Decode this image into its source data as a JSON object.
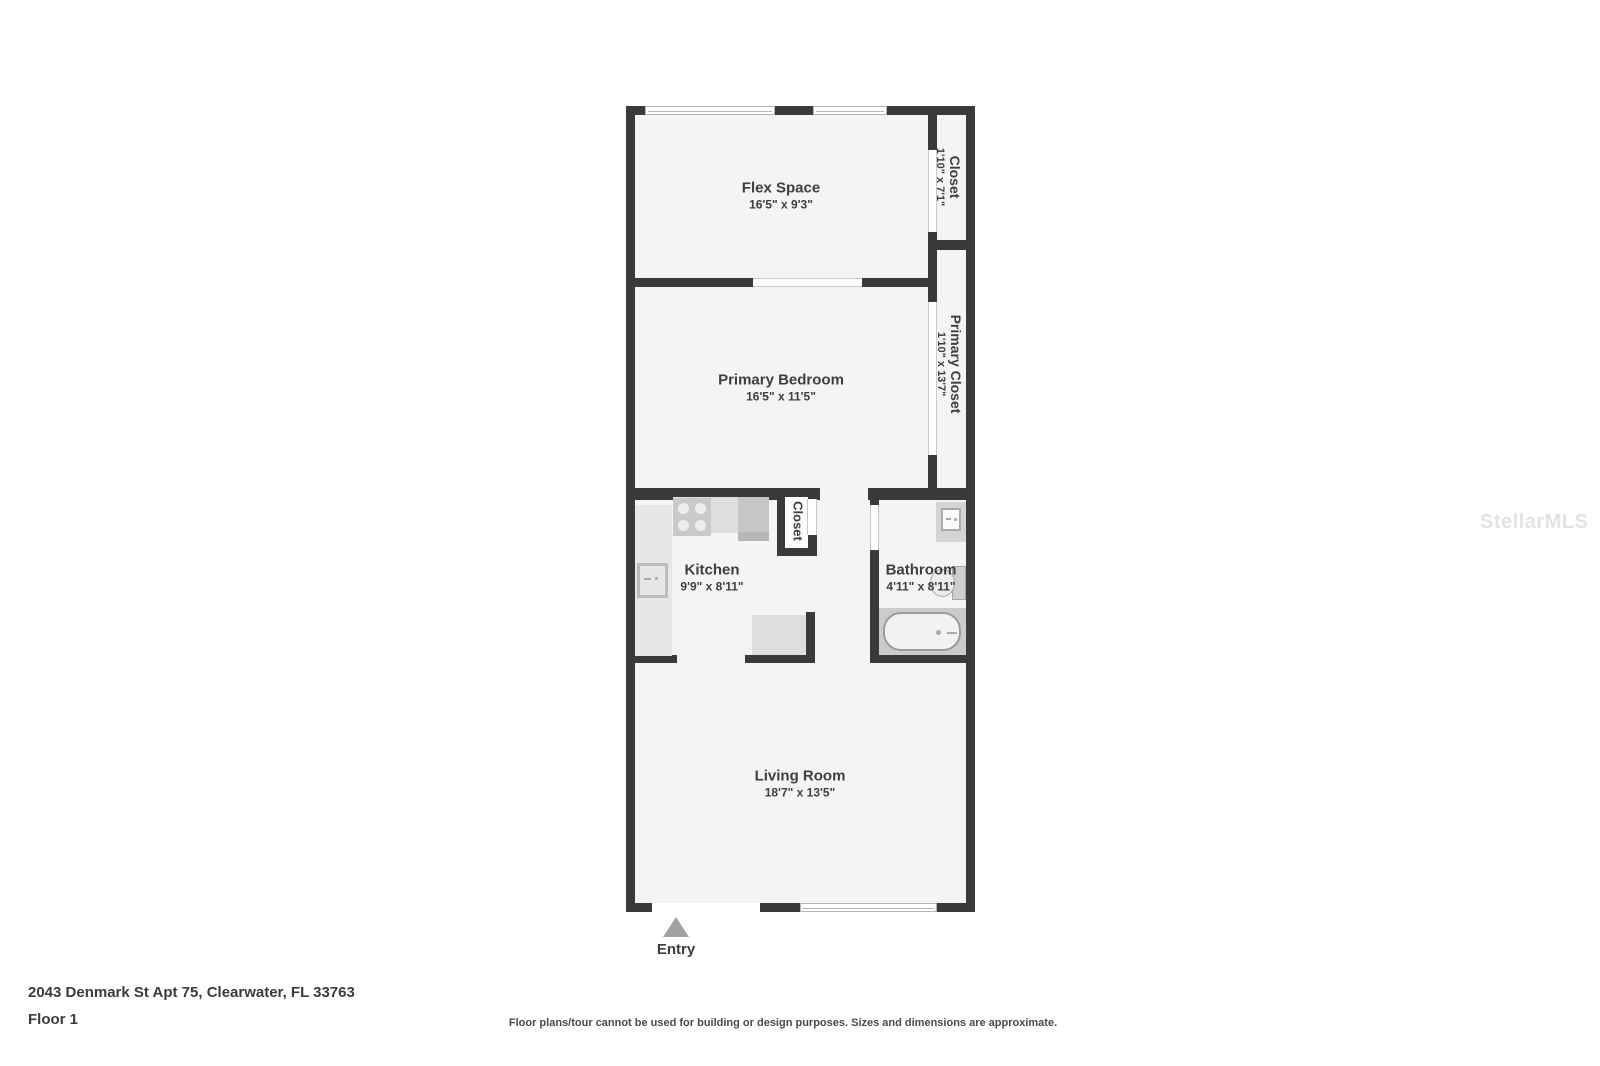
{
  "rooms": {
    "flex_space": {
      "name": "Flex Space",
      "dims": "16'5\" x 9'3\""
    },
    "primary_bedroom": {
      "name": "Primary Bedroom",
      "dims": "16'5\" x 11'5\""
    },
    "kitchen": {
      "name": "Kitchen",
      "dims": "9'9\" x 8'11\""
    },
    "bathroom": {
      "name": "Bathroom",
      "dims": "4'11\" x 8'11\""
    },
    "living_room": {
      "name": "Living Room",
      "dims": "18'7\" x 13'5\""
    },
    "closet": {
      "name": "Closet",
      "dims": "1'10\" x 7'1\""
    },
    "primary_closet": {
      "name": "Primary Closet",
      "dims": "1'10\" x 13'7\""
    },
    "kitchen_closet": {
      "name": "Closet"
    }
  },
  "entry": {
    "label": "Entry"
  },
  "footer": {
    "address": "2043 Denmark St Apt 75, Clearwater, FL 33763",
    "floor_label": "Floor 1",
    "disclaimer": "Floor plans/tour cannot be used for building or design purposes. Sizes and dimensions are approximate."
  },
  "watermark": {
    "text": "StellarMLS"
  },
  "colors": {
    "wall": "#3a3a3a",
    "floor": "#f4f4f4",
    "fixture_gray": "#d9d9d9",
    "entry_arrow": "#a2a2a2"
  }
}
